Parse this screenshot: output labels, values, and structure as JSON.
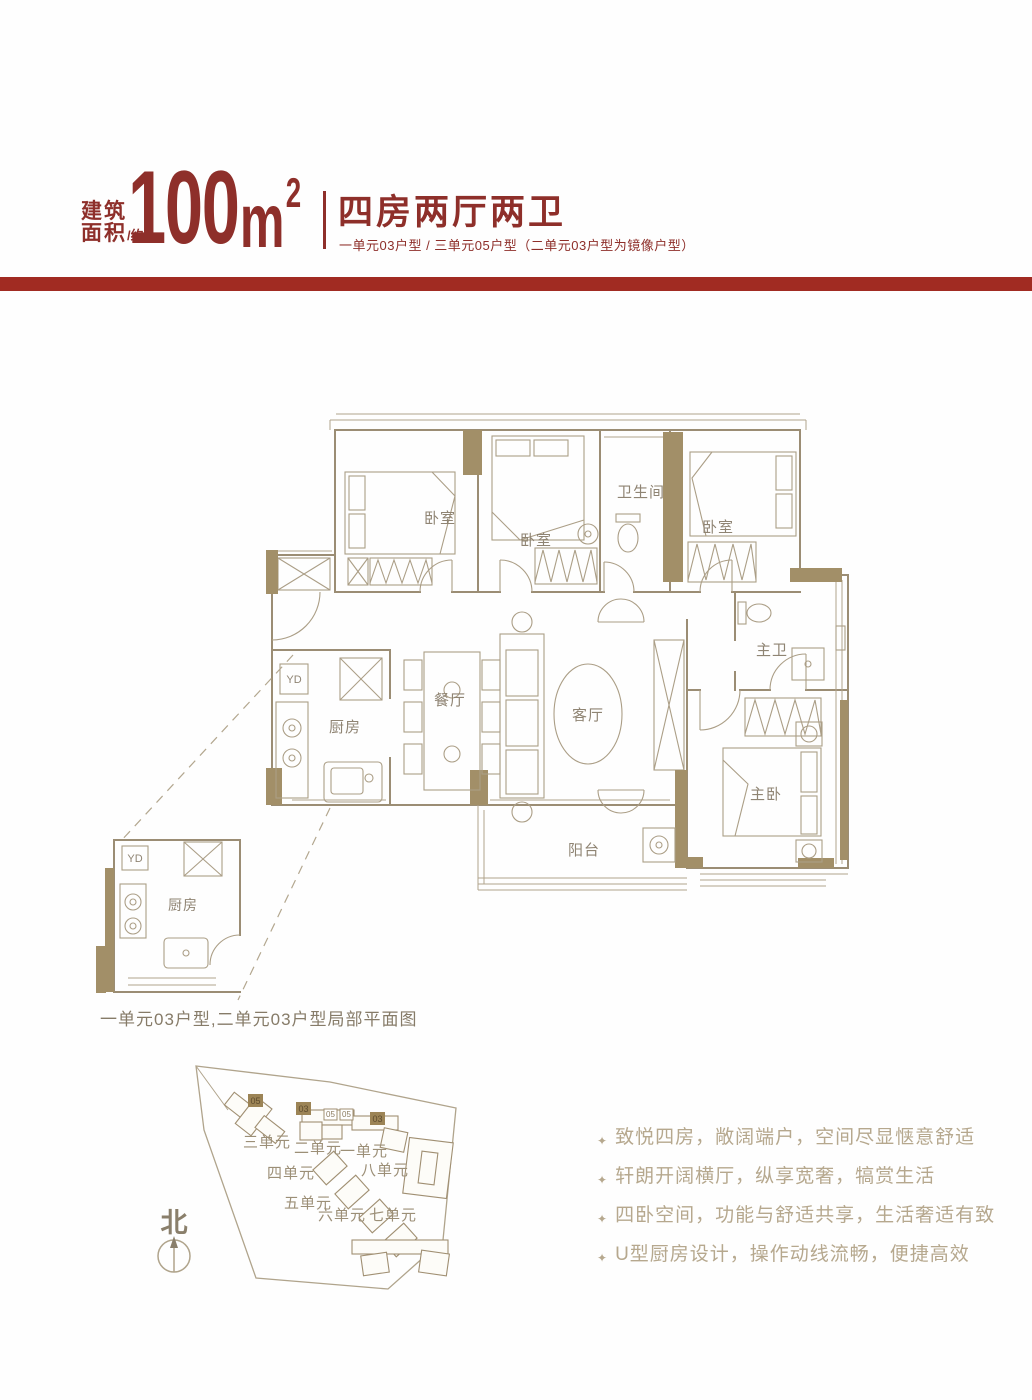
{
  "header": {
    "area_label_line1": "建筑",
    "area_label_line2": "面积",
    "area_label_suffix": "/约",
    "area_value": "100",
    "area_unit": "m",
    "area_sup": "2",
    "title": "四房两厅两卫",
    "subtitle": "一单元03户型 / 三单元05户型（二单元03户型为镜像户型）"
  },
  "colors": {
    "maroon": "#8e2f2a",
    "bar_red": "#a12b22",
    "wall_line": "#9b8d74",
    "pier_tan": "#a28f68",
    "plan_label": "#8f8473",
    "feature_text": "#b6a88e"
  },
  "floorplan": {
    "yd_label": "YD",
    "rooms": [
      {
        "id": "bedroom-1",
        "label": "卧室"
      },
      {
        "id": "bedroom-2",
        "label": "卧室"
      },
      {
        "id": "bathroom",
        "label": "卫生间"
      },
      {
        "id": "bedroom-3",
        "label": "卧室"
      },
      {
        "id": "master-bath",
        "label": "主卫"
      },
      {
        "id": "kitchen",
        "label": "厨房"
      },
      {
        "id": "dining",
        "label": "餐厅"
      },
      {
        "id": "living",
        "label": "客厅"
      },
      {
        "id": "master-bedroom",
        "label": "主卧"
      },
      {
        "id": "balcony",
        "label": "阳台"
      }
    ],
    "detail": {
      "kitchen_label": "厨房",
      "yd_label": "YD",
      "caption": "一单元03户型,二单元03户型局部平面图"
    }
  },
  "siteplan": {
    "north_label": "北",
    "units": [
      "三单元",
      "二单元",
      "一单元",
      "四单元",
      "八单元",
      "五单元",
      "六单元",
      "七单元"
    ],
    "markers": [
      "05",
      "03",
      "05",
      "05",
      "03"
    ]
  },
  "features": {
    "bullet": "✦",
    "items": [
      "致悦四房，敞阔端户，空间尽显惬意舒适",
      "轩朗开阔横厅，纵享宽奢，犒赏生活",
      "四卧空间，功能与舒适共享，生活奢适有致",
      "U型厨房设计，操作动线流畅，便捷高效"
    ]
  }
}
